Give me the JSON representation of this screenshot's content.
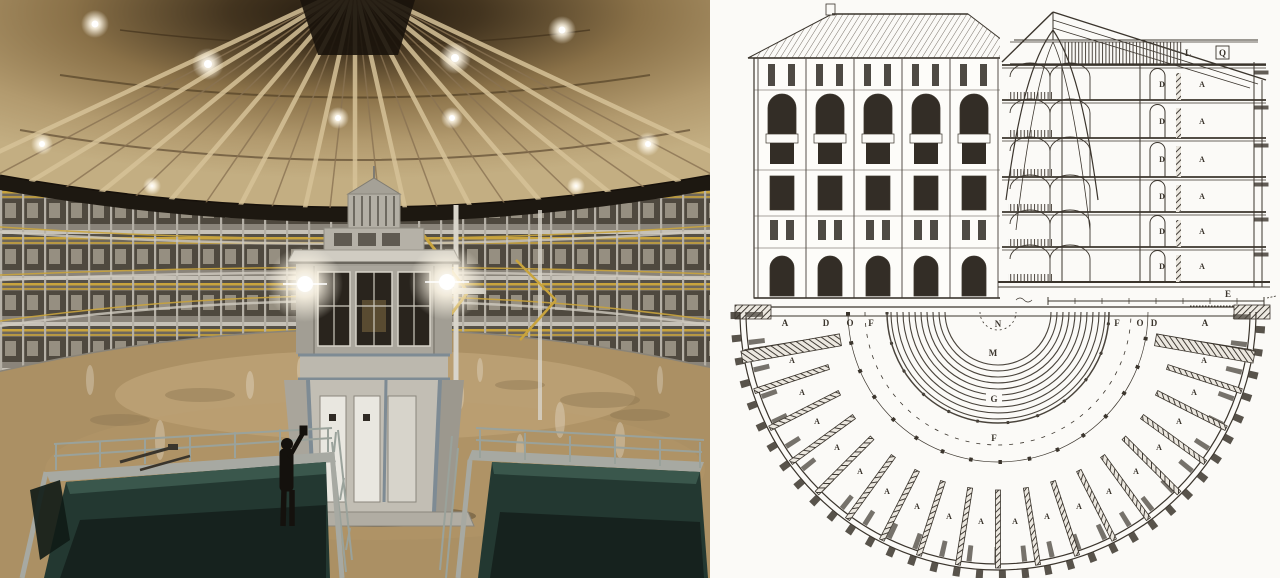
{
  "image": {
    "left_panel": "photograph of circular panopticon prison interior with central guard tower",
    "right_panel": "historic panopticon architectural drawing: elevation, section and half-circular plan"
  },
  "photo": {
    "colors": {
      "dome_shadow": "#1f170d",
      "dome_wood": "#b09468",
      "truss": "#d6c298",
      "cell_wall": "#6e675c",
      "railing_yellow": "#c9a43d",
      "floor": "#ab9064",
      "floor_highlight": "#cbb286",
      "pit_teal": "#233831",
      "pit_wall": "#3a574c",
      "pit_deep": "#141f1b",
      "coping_gray": "#a7a9a2",
      "tower_light": "#c2beb4",
      "tower_trim": "#7e8b94"
    }
  },
  "drawing": {
    "ink": "#3b352d",
    "paper": "#fbfaf7",
    "section": {
      "attic_letters": [
        "L",
        "Q"
      ],
      "gallery_letter": "D",
      "cell_letter": "A",
      "ground_letter": "E"
    },
    "plan": {
      "edge_letters_left": [
        "A",
        "D",
        "O",
        "F"
      ],
      "edge_letter_center": "N",
      "edge_letters_right": [
        "F",
        "O",
        "D",
        "A"
      ],
      "center_letters": [
        "M",
        "G",
        "F"
      ],
      "cell_letter": "A"
    }
  }
}
